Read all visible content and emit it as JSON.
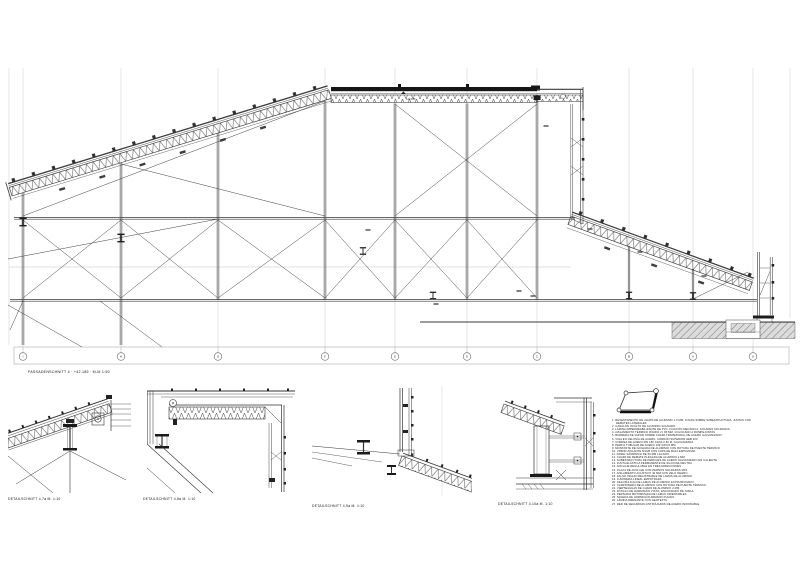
{
  "sheet": {
    "background": "#ffffff",
    "line_color": "#3a3a3a",
    "grid_line_color": "#c9c9c9"
  },
  "main_section": {
    "caption": "FASSADENSCHNITT 4  ·  +42.185  ·  M-M  1:50",
    "level_top": "+42.185",
    "grid_labels": [
      "I",
      "H",
      "G",
      "F",
      "E",
      "D",
      "C",
      "B",
      "A",
      "O"
    ]
  },
  "details": [
    {
      "caption": "DETAILSCHNITT 4.7a  M. 1:10"
    },
    {
      "caption": "DETAILSCHNITT 4.8a  M. 1:10"
    },
    {
      "caption": "DETAILSCHNITT 4.9a  M. 1:10"
    },
    {
      "caption": "DETAILSCHNITT 4.10a  M. 1:10"
    }
  ],
  "legend": {
    "items": [
      "1. REVESTIMIENTO DE CHAPA DE ALUMINIO 1.5 MM, FIJADA SOBRE SUBESTRUCTURA, JUNTAS CON REMATES LATERALES",
      "2. CANALÓN OCULTO DE ALUMINIO SOLDADO",
      "3. LÁMINA IMPERMEABILIZANTE DE PVC, FIJACIÓN MECÁNICA, SOLAPES SOLDADOS",
      "4. AISLAMIENTO TÉRMICO RÍGIDO 2× 80 MM, COLOCADO A ROMPEJUNTAS",
      "5. BARRERA DE VAPOR SOBRE CHAPA TRAPEZOIDAL DE ACERO GALVANIZADO",
      "6. VIGA EN CELOSÍA DE ACERO, CORDÓN SUPERIOR HEB 200",
      "7. CORREA DE ACERO IPE 180 CADA 2.50 M, GALVANIZADA",
      "8. PERFIL TUBULAR DE ACERO 100×100×5 MM",
      "9. MONTANTE DE FACHADA DE ALUMINIO CON ROTURA DE PUENTE TÉRMICO",
      "10. VIDRIO AISLANTE 8/16/8 CON CAPA DE BAJA EMISIVIDAD",
      "11. PANEL SÁNDWICH DE 60 MM LACADO",
      "12. CHAPA DE REMATE PLEGADA DE ALUMINIO 2 MM",
      "13. SUBESTRUCTURA DE PERFILES DE ACERO GALVANIZADO EN CALIENTE",
      "14. JUNTA ELÁSTICA PERMANENTE DE SILICONA NEUTRA",
      "15. ANCLAJE REGULABLE EN TRES DIRECCIONES",
      "16. PLACA DE ANCLAJE CON PERNOS SOLDADOS M16",
      "17. AISLAMIENTO ACÚSTICO 40 MM CON VELO NEGRO",
      "18. FALSO TECHO REGISTRABLE DE LAMAS DE ALUMINIO",
      "19. LUMINARIA LINEAL EMPOTRADA",
      "20. CELOSÍA FIJA DE LAMAS DE ALUMINIO EXTRUSIONADO",
      "21. CARPINTERÍA DE ALUMINIO CON ROTURA DE PUENTE TÉRMICO",
      "22. VIERTEAGUAS DE CHAPA DE ALUMINIO 2 MM",
      "23. ZÓCALO DE HORMIGÓN VISTO, ENCOFRADO DE TABLA",
      "24. PERSIANA MOTORIZADA DE LAMAS ORIENTABLES",
      "25. SOLERA DE HORMIGÓN ARMADO PULIDO",
      "26. LÁMINA DRENANTE CON GEOTEXTIL",
      "27. RED DE SEGURIDAD ANTIPÁJAROS DE ACERO INOXIDABLE"
    ]
  }
}
